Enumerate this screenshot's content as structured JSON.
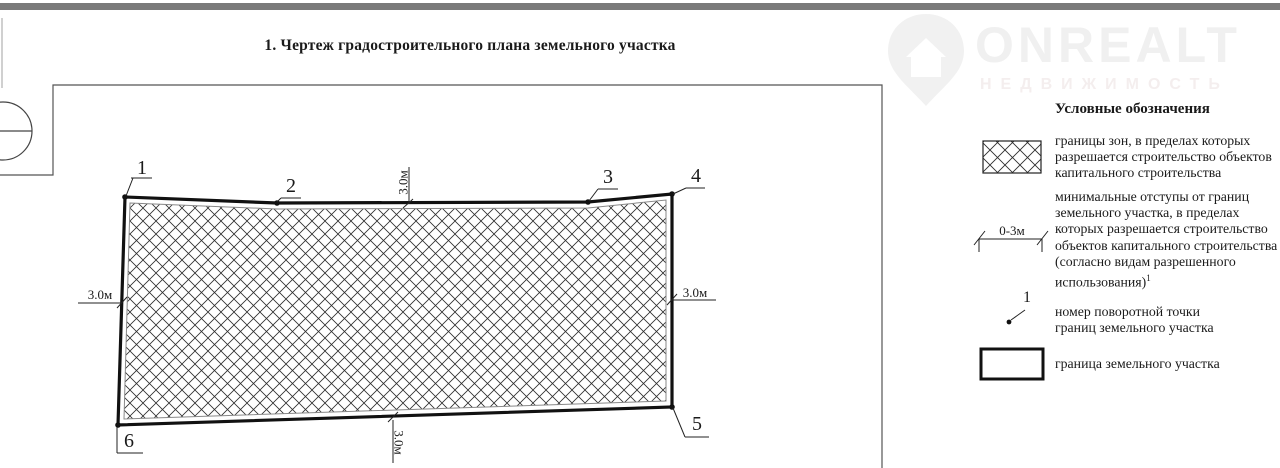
{
  "page": {
    "title": "1. Чертеж градостроительного плана земельного участка"
  },
  "watermark": {
    "brand": "ONREALT",
    "tagline": "НЕДВИЖИМОСТЬ",
    "icon": "house-pin-icon",
    "color": "#f0f0f0"
  },
  "plan": {
    "point_labels": [
      "1",
      "2",
      "3",
      "4",
      "5",
      "6"
    ],
    "dim_top": "3.0м",
    "dim_left": "3.0м",
    "dim_right": "3.0м",
    "dim_bottom": "3.0м"
  },
  "legend": {
    "title": "Условные обозначения",
    "items": [
      {
        "symbol": "crosshatch-swatch",
        "lines": [
          "границы зон, в пределах которых",
          "разрешается строительство объектов",
          "капитального строительства"
        ]
      },
      {
        "symbol": "setback-dimension",
        "label": "0-3м",
        "lines": [
          "минимальные отступы от границ",
          "земельного участка, в пределах",
          "которых разрешается строительство",
          "объектов капитального строительства",
          "(согласно видам разрешенного",
          "использования)"
        ],
        "sup": "1"
      },
      {
        "symbol": "turning-point",
        "label": "1",
        "lines": [
          "номер поворотной точки",
          "границ земельного участка"
        ]
      },
      {
        "symbol": "plot-boundary-swatch",
        "lines": [
          "граница земельного участка"
        ]
      }
    ]
  },
  "colors": {
    "line": "#111111",
    "frame": "#555555",
    "topbar": "#7a7a7a",
    "watermark": "#f0f0f0"
  }
}
